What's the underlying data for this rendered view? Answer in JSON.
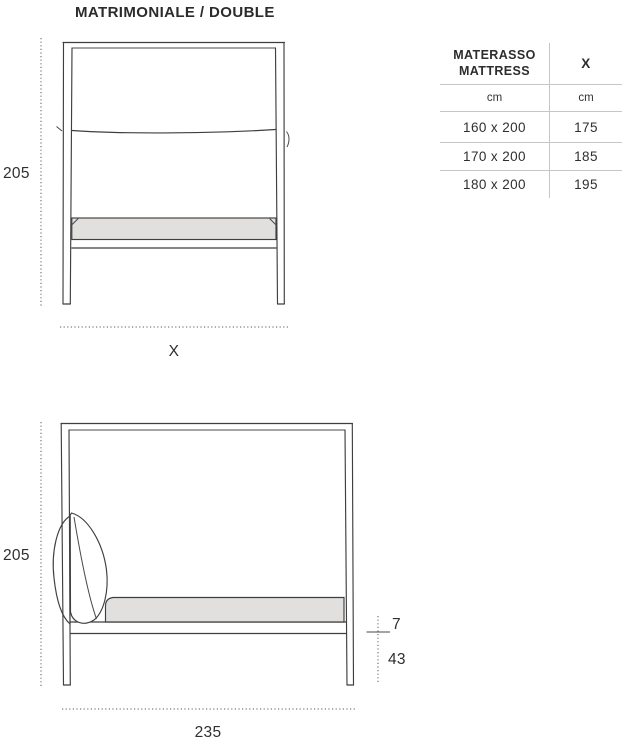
{
  "title": "MATRIMONIALE / DOUBLE",
  "front_view": {
    "height_label": "205",
    "width_label": "X"
  },
  "side_view": {
    "height_label": "205",
    "rail_thickness_label": "7",
    "frame_height_label": "43",
    "width_label": "235"
  },
  "table": {
    "header": {
      "col1_line1": "MATERASSO",
      "col1_line2": "MATTRESS",
      "col2": "X"
    },
    "units": {
      "col1": "cm",
      "col2": "cm"
    },
    "rows": [
      {
        "mattress": "160 x 200",
        "x": "175"
      },
      {
        "mattress": "170 x 200",
        "x": "185"
      },
      {
        "mattress": "180 x 200",
        "x": "195"
      }
    ]
  },
  "colors": {
    "line": "#3f3f3f",
    "dimension_line": "#5a5a5a",
    "table_border": "#c6c6c6",
    "text": "#2d2d2d",
    "mattress_fill": "#e1e0de"
  }
}
